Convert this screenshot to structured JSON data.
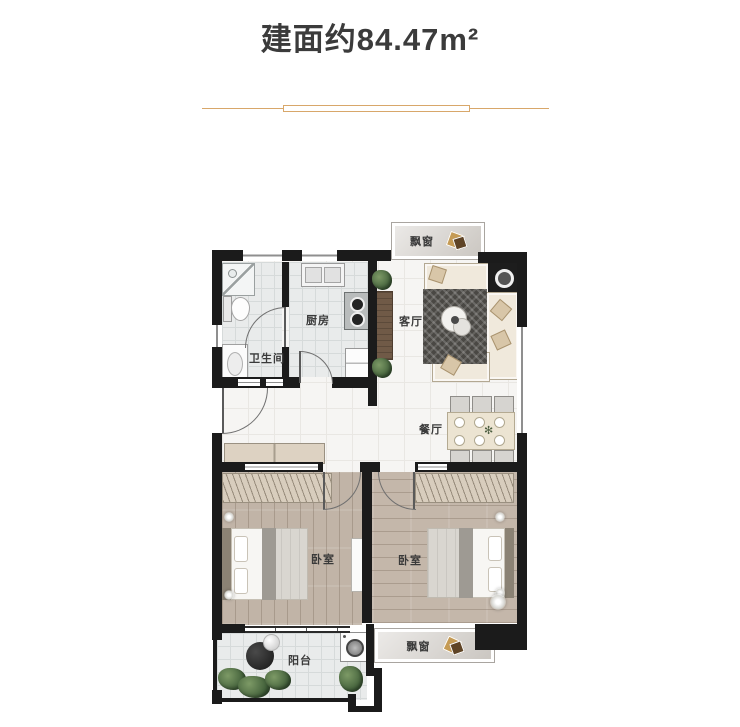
{
  "header": {
    "title": "建面约84.47m²"
  },
  "divider": {
    "color": "#d8a76a"
  },
  "floorplan": {
    "rooms": {
      "bay_window_top": "飘窗",
      "kitchen": "厨房",
      "living_room": "客厅",
      "bathroom": "卫生间",
      "dining_room": "餐厅",
      "bedroom_left": "卧室",
      "bedroom_right": "卧室",
      "balcony": "阳台",
      "bay_window_bottom": "飘窗"
    },
    "colors": {
      "wall": "#1b1b1b",
      "label_text": "#3a3a3a",
      "wood_floor": "#c1b4a7",
      "tile_floor": "#e9ebeb",
      "marble_floor": "#f6f5f3",
      "bay_marble": "#d7d3ce",
      "sofa": "#f0e9dc",
      "rug": "#4a4844",
      "divider_gold": "#d8a76a"
    }
  }
}
